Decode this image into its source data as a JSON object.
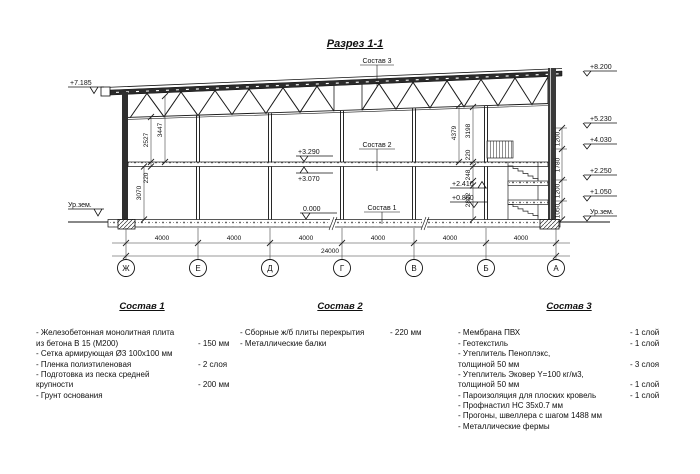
{
  "title": "Разрез 1-1",
  "drawing": {
    "sostav_labels": {
      "s1": "Состав 1",
      "s2": "Состав 2",
      "s3": "Состав 3"
    },
    "elev": {
      "left_top": "+7.185",
      "left_ground": "Ур.зем.",
      "right": [
        "+8.200",
        "+5.230",
        "+4.030",
        "+2.250",
        "+1.050",
        "Ур.зем."
      ],
      "slab_top": "+3.290",
      "slab_bottom": "+3.070",
      "floor": "0.000",
      "stair_upper": "+2.410",
      "stair_lower": "+0.860"
    },
    "dims": {
      "left": [
        "2527",
        "3447",
        "220",
        "3070"
      ],
      "inner": [
        "4379",
        "3198",
        "220",
        "248",
        "2822"
      ],
      "right": [
        "1200",
        "1780",
        "1200",
        "1050"
      ],
      "bays": [
        "4000",
        "4000",
        "4000",
        "4000",
        "4000",
        "4000"
      ],
      "total": "24000"
    },
    "axes": [
      "Ж",
      "Е",
      "Д",
      "Г",
      "В",
      "Б",
      "А"
    ]
  },
  "compositions": [
    {
      "heading": "Состав 1",
      "items": [
        {
          "text": "- Железобетонная  монолитная плита\n  из бетона В 15 (М200)",
          "value": "- 150 мм"
        },
        {
          "text": "- Сетка армирующая Ø3 100х100 мм",
          "value": ""
        },
        {
          "text": "- Пленка полиэтиленовая",
          "value": "- 2 слоя"
        },
        {
          "text": "- Подготовка из песка средней\n  крупности",
          "value": "- 200 мм"
        },
        {
          "text": "- Грунт основания",
          "value": ""
        }
      ]
    },
    {
      "heading": "Состав 2",
      "items": [
        {
          "text": "- Сборные ж/б плиты перекрытия",
          "value": "- 220 мм"
        },
        {
          "text": "- Металлические балки",
          "value": ""
        }
      ]
    },
    {
      "heading": "Состав 3",
      "items": [
        {
          "text": "- Мембрана ПВХ",
          "value": "- 1 слой"
        },
        {
          "text": "- Геотекстиль",
          "value": "- 1 слой"
        },
        {
          "text": "- Утеплитель Пеноплэкс,\n  толщиной 50 мм",
          "value": "- 3 слоя"
        },
        {
          "text": "- Утеплитель Эковер Y=100 кг/м3,\n  толщиной 50 мм",
          "value": "- 1 слой"
        },
        {
          "text": "- Пароизоляция для плоских кровель",
          "value": "- 1 слой"
        },
        {
          "text": "- Профнастил НС 35х0.7 мм",
          "value": ""
        },
        {
          "text": "- Прогоны, швеллера с шагом 1488 мм",
          "value": ""
        },
        {
          "text": "- Металлические фермы",
          "value": ""
        }
      ]
    }
  ]
}
